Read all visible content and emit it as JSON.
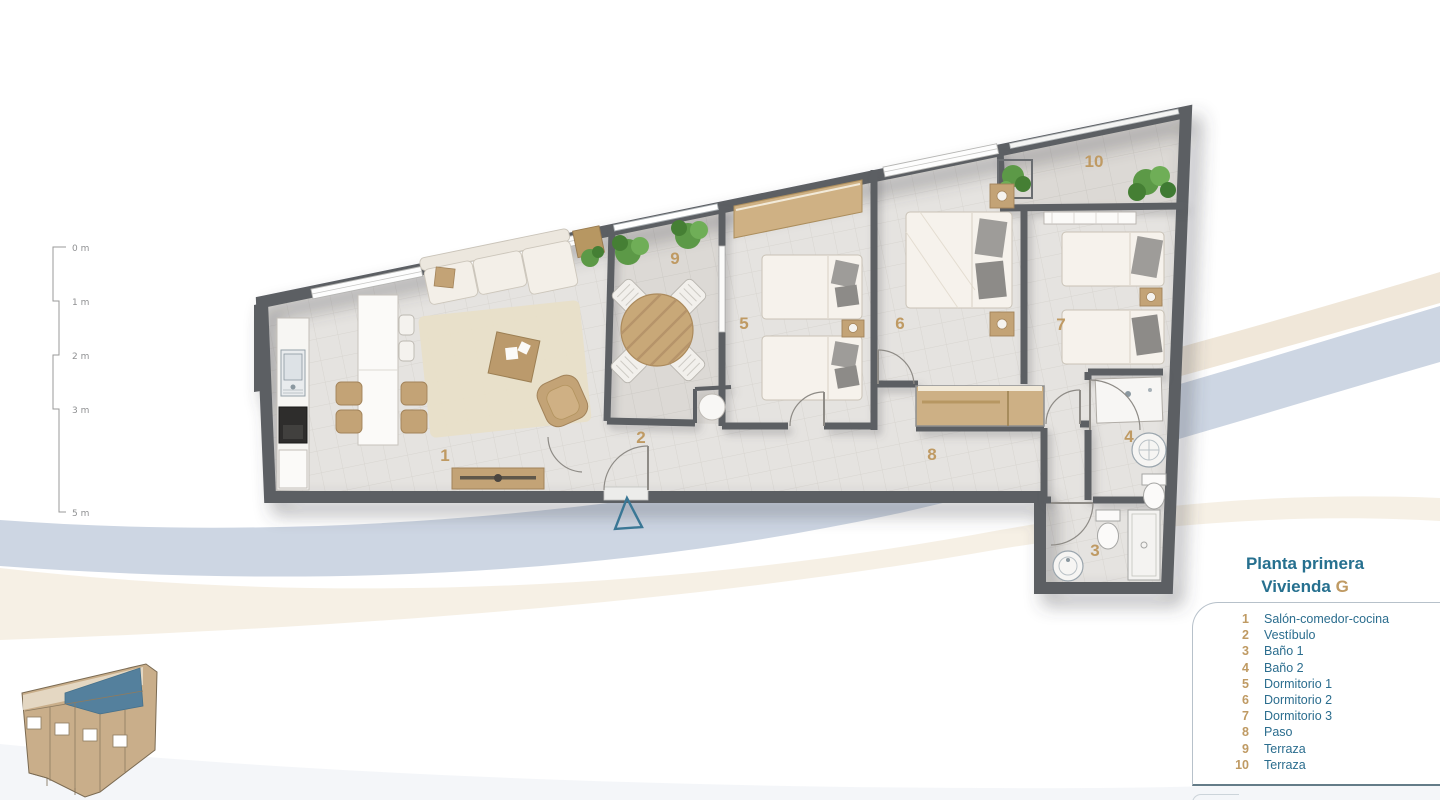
{
  "title": {
    "line1": "Planta primera",
    "line2_word": "Vivienda",
    "line2_letter": "G"
  },
  "legend": {
    "items": [
      {
        "num": "1",
        "label": "Salón-comedor-cocina"
      },
      {
        "num": "2",
        "label": "Vestíbulo"
      },
      {
        "num": "3",
        "label": "Baño 1"
      },
      {
        "num": "4",
        "label": "Baño 2"
      },
      {
        "num": "5",
        "label": "Dormitorio 1"
      },
      {
        "num": "6",
        "label": "Dormitorio 2"
      },
      {
        "num": "7",
        "label": "Dormitorio 3"
      },
      {
        "num": "8",
        "label": "Paso"
      },
      {
        "num": "9",
        "label": "Terraza"
      },
      {
        "num": "10",
        "label": "Terraza"
      }
    ]
  },
  "plan": {
    "room_numbers": [
      "1",
      "2",
      "3",
      "4",
      "5",
      "6",
      "7",
      "8",
      "9",
      "10"
    ]
  },
  "scale": {
    "labels": [
      "0 m",
      "1 m",
      "2 m",
      "3 m",
      "5 m"
    ]
  },
  "colors": {
    "title-blue": "#26708f",
    "legend-blue": "#2b6d8e",
    "accent-tan": "#bf9a63",
    "wall-gray": "#5c5f64",
    "floor-gray": "#e5e3e0",
    "swoosh-blue": "#cdd6e3",
    "swoosh-cream": "#f0e7d9",
    "site-tan": "#c9ae8a",
    "site-highlight": "#54809d",
    "entry-arrow-blue": "#3a7795"
  }
}
